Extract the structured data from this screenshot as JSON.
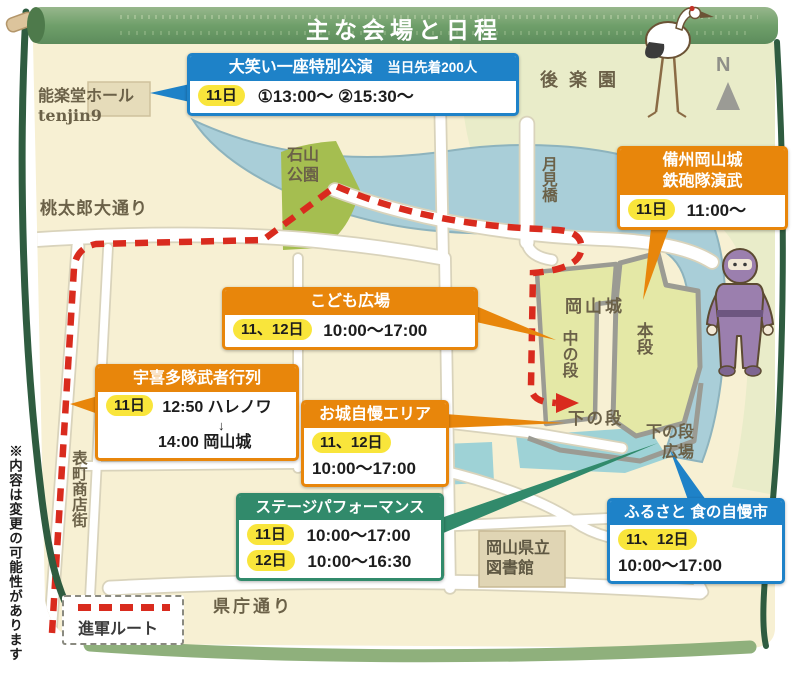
{
  "title": "主な会場と日程",
  "note": "※内容は変更の可能性があります",
  "compass": "N",
  "legend": {
    "route_label": "進軍ルート"
  },
  "colors": {
    "route_red": "#d92b1e",
    "orange": "#e8860b",
    "blue": "#1e82c8",
    "green": "#318a6b",
    "pill_yellow": "#f9e53b",
    "scroll_green": "#6f9f6a"
  },
  "events": {
    "owarai": {
      "name": "大笑い一座特別公演",
      "note": "当日先着200人",
      "days": "11日",
      "time": "①13:00〜 ②15:30〜"
    },
    "teppotai": {
      "name_line1": "備州岡山城",
      "name_line2": "鉄砲隊演武",
      "days": "11日",
      "time": "11:00〜"
    },
    "kodomo": {
      "name": "こども広場",
      "days": "11、12日",
      "time": "10:00〜17:00"
    },
    "ukita": {
      "name": "宇喜多隊武者行列",
      "days": "11日",
      "time1": "12:50 ハレノワ",
      "arrow": "↓",
      "time2": "14:00 岡山城"
    },
    "oshiro": {
      "name": "お城自慢エリア",
      "days": "11、12日",
      "time": "10:00〜17:00"
    },
    "stage": {
      "name": "ステージパフォーマンス",
      "rows": [
        {
          "days": "11日",
          "time": "10:00〜17:00"
        },
        {
          "days": "12日",
          "time": "10:00〜16:30"
        }
      ]
    },
    "furusato": {
      "name": "ふるさと 食の自慢市",
      "days": "11、12日",
      "time": "10:00〜17:00"
    }
  },
  "map_labels": {
    "nohgakudo_line1": "能楽堂ホール",
    "nohgakudo_line2": "tenjin9",
    "korakuen": "後楽園",
    "ishiyama_line1": "石山",
    "ishiyama_line2": "公園",
    "tsukimibashi": "月見橋",
    "momotaro_dori": "桃太郎大通り",
    "omotecho": "表町商店街",
    "kencho_dori": "県庁通り",
    "okayama_castle": "岡山城",
    "hondan": "本段",
    "nakanodan": "中の段",
    "shimonodan": "下の段",
    "shimonodan_hiroba_line1": "下の段",
    "shimonodan_hiroba_line2": "広場",
    "library_line1": "岡山県立",
    "library_line2": "図書館"
  }
}
